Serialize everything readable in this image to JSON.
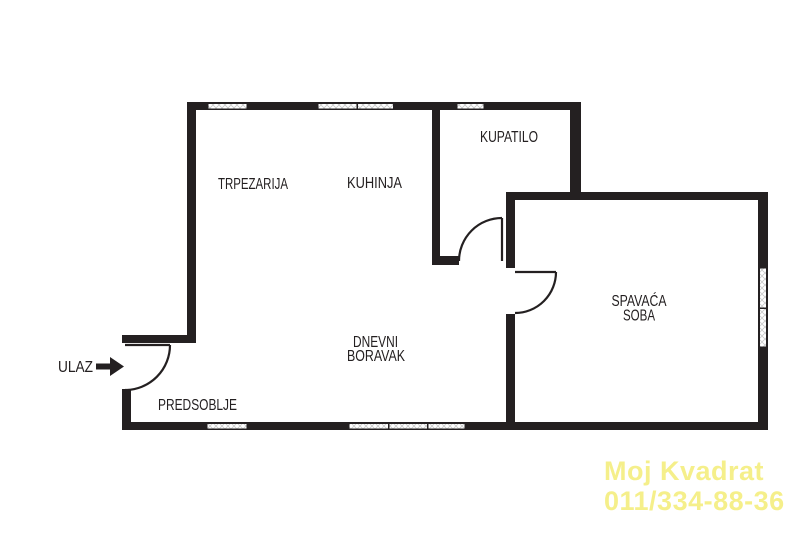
{
  "rooms": {
    "trpezarija": {
      "label": "TRPEZARIJA"
    },
    "kuhinja": {
      "label": "KUHINJA"
    },
    "kupatilo": {
      "label": "KUPATILO"
    },
    "spavaca_soba": {
      "line1": "SPAVAĆA",
      "line2": "SOBA"
    },
    "dnevni_boravak": {
      "line1": "DNEVNI",
      "line2": "BORAVAK"
    },
    "predsoblje": {
      "label": "PREDSOBLJE"
    }
  },
  "entrance": {
    "label": "ULAZ",
    "icon": "right-arrow-icon"
  },
  "watermark": {
    "line1": "Moj Kvadrat",
    "line2": "011/334-88-36"
  },
  "colors": {
    "wall": "#242021",
    "label_text": "#242021",
    "watermark_yellow": "#f5ef8a",
    "window_hatch": "#c9c9c9"
  }
}
